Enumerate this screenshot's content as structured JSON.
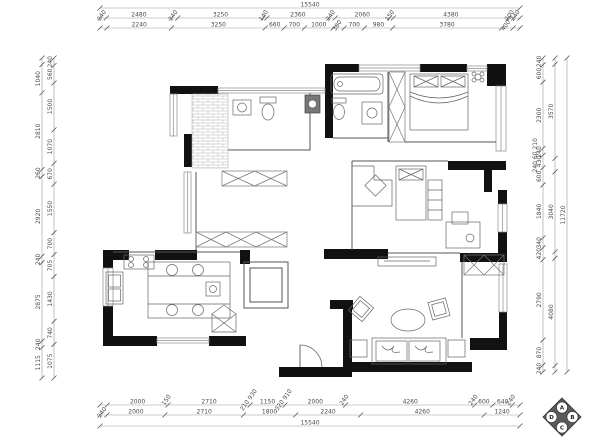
{
  "drawing": {
    "type": "residential-floor-plan",
    "units": "mm",
    "overall_width_label": "15540",
    "overall_height_label": "11720"
  },
  "colors": {
    "wall": "#111111",
    "thin_wall": "#444444",
    "furniture": "#666666",
    "dim_line": "#999999",
    "dim_text": "#4a4a4a"
  },
  "dimensions": {
    "top_overall": [
      {
        "v": 15540,
        "t": "15540"
      }
    ],
    "top_row1": [
      {
        "v": 240,
        "t": "240"
      },
      {
        "v": 2480,
        "t": "2480"
      },
      {
        "v": 240,
        "t": "240"
      },
      {
        "v": 3250,
        "t": "3250"
      },
      {
        "v": 140,
        "t": "140"
      },
      {
        "v": 2360,
        "t": "2360"
      },
      {
        "v": 240,
        "t": "240"
      },
      {
        "v": 2060,
        "t": "2060"
      },
      {
        "v": 150,
        "t": "150"
      },
      {
        "v": 4380,
        "t": "4380"
      },
      {
        "v": 200,
        "t": "200"
      },
      {
        "v": 240,
        "t": "240"
      }
    ],
    "top_row2": [
      {
        "v": 240,
        "t": ""
      },
      {
        "v": 2240,
        "t": "2240"
      },
      {
        "v": 3250,
        "t": "3250"
      },
      {
        "v": 660,
        "t": "660"
      },
      {
        "v": 700,
        "t": "700"
      },
      {
        "v": 1000,
        "t": "1000"
      },
      {
        "v": 380,
        "t": "380"
      },
      {
        "v": 700,
        "t": "700"
      },
      {
        "v": 980,
        "t": "980"
      },
      {
        "v": 3780,
        "t": "3780"
      },
      {
        "v": 400,
        "t": "400"
      },
      {
        "v": 240,
        "t": ""
      }
    ],
    "bottom_row1": [
      {
        "v": 240,
        "t": ""
      },
      {
        "v": 2000,
        "t": "2000"
      },
      {
        "v": 2710,
        "t": "2710"
      },
      {
        "v": 1150,
        "t": "1150"
      },
      {
        "v": 2000,
        "t": "2000"
      },
      {
        "v": 4260,
        "t": "4260"
      },
      {
        "v": 600,
        "t": "600"
      },
      {
        "v": 640,
        "t": "640"
      },
      {
        "v": 250,
        "t": ""
      }
    ],
    "bottom_row1_ticks": [
      {
        "after": 2,
        "t": "150"
      },
      {
        "after": 3,
        "t": "210 930"
      },
      {
        "after": 4,
        "t": "320 910"
      },
      {
        "after": 5,
        "t": "240"
      },
      {
        "after": 6,
        "t": "240"
      },
      {
        "after": 8,
        "t": "240"
      }
    ],
    "bottom_row2": [
      {
        "v": 240,
        "t": "240"
      },
      {
        "v": 2000,
        "t": "2000"
      },
      {
        "v": 2710,
        "t": "2710"
      },
      {
        "v": 1800,
        "t": "1800"
      },
      {
        "v": 2240,
        "t": "2240"
      },
      {
        "v": 4260,
        "t": "4260"
      },
      {
        "v": 1240,
        "t": "1240"
      }
    ],
    "bottom_overall": [
      {
        "v": 15540,
        "t": "15540"
      }
    ],
    "left_outer": [
      {
        "v": 240,
        "t": ""
      },
      {
        "v": 1040,
        "t": "1040"
      },
      {
        "v": 2810,
        "t": "2810"
      },
      {
        "v": 260,
        "t": "260"
      },
      {
        "v": 2920,
        "t": "2920"
      },
      {
        "v": 240,
        "t": "240"
      },
      {
        "v": 2875,
        "t": "2875"
      },
      {
        "v": 240,
        "t": "240"
      },
      {
        "v": 1115,
        "t": "1115"
      }
    ],
    "left_inner": [
      {
        "v": 240,
        "t": "240"
      },
      {
        "v": 560,
        "t": "560"
      },
      {
        "v": 1500,
        "t": "1500"
      },
      {
        "v": 1070,
        "t": "1070"
      },
      {
        "v": 670,
        "t": "670"
      },
      {
        "v": 1550,
        "t": "1550"
      },
      {
        "v": 700,
        "t": "700"
      },
      {
        "v": 705,
        "t": "705"
      },
      {
        "v": 1430,
        "t": "1430"
      },
      {
        "v": 740,
        "t": "740"
      },
      {
        "v": 1075,
        "t": "1075"
      }
    ],
    "right_inner": [
      {
        "v": 240,
        "t": "240"
      },
      {
        "v": 600,
        "t": "600"
      },
      {
        "v": 2300,
        "t": "2300"
      },
      {
        "v": 240,
        "t": "240"
      },
      {
        "v": 430,
        "t": "430"
      },
      {
        "v": 600,
        "t": "600"
      },
      {
        "v": 1840,
        "t": "1840"
      },
      {
        "v": 340,
        "t": "340"
      },
      {
        "v": 420,
        "t": "420"
      },
      {
        "v": 2790,
        "t": "2790"
      },
      {
        "v": 870,
        "t": "870"
      },
      {
        "v": 240,
        "t": "240"
      }
    ],
    "right_inner_ticks": [
      {
        "after": 4,
        "t": "240 60 210"
      }
    ],
    "right_mid": [
      {
        "v": 240,
        "t": ""
      },
      {
        "v": 3570,
        "t": "3570"
      },
      {
        "v": 510,
        "t": ""
      },
      {
        "v": 3040,
        "t": "3040"
      },
      {
        "v": 240,
        "t": ""
      },
      {
        "v": 4080,
        "t": "4080"
      },
      {
        "v": 240,
        "t": ""
      }
    ],
    "right_overall": [
      {
        "v": 11720,
        "t": "11720"
      }
    ]
  },
  "elevation_marker": {
    "top": "A",
    "right": "B",
    "bottom": "C",
    "left": "D"
  }
}
